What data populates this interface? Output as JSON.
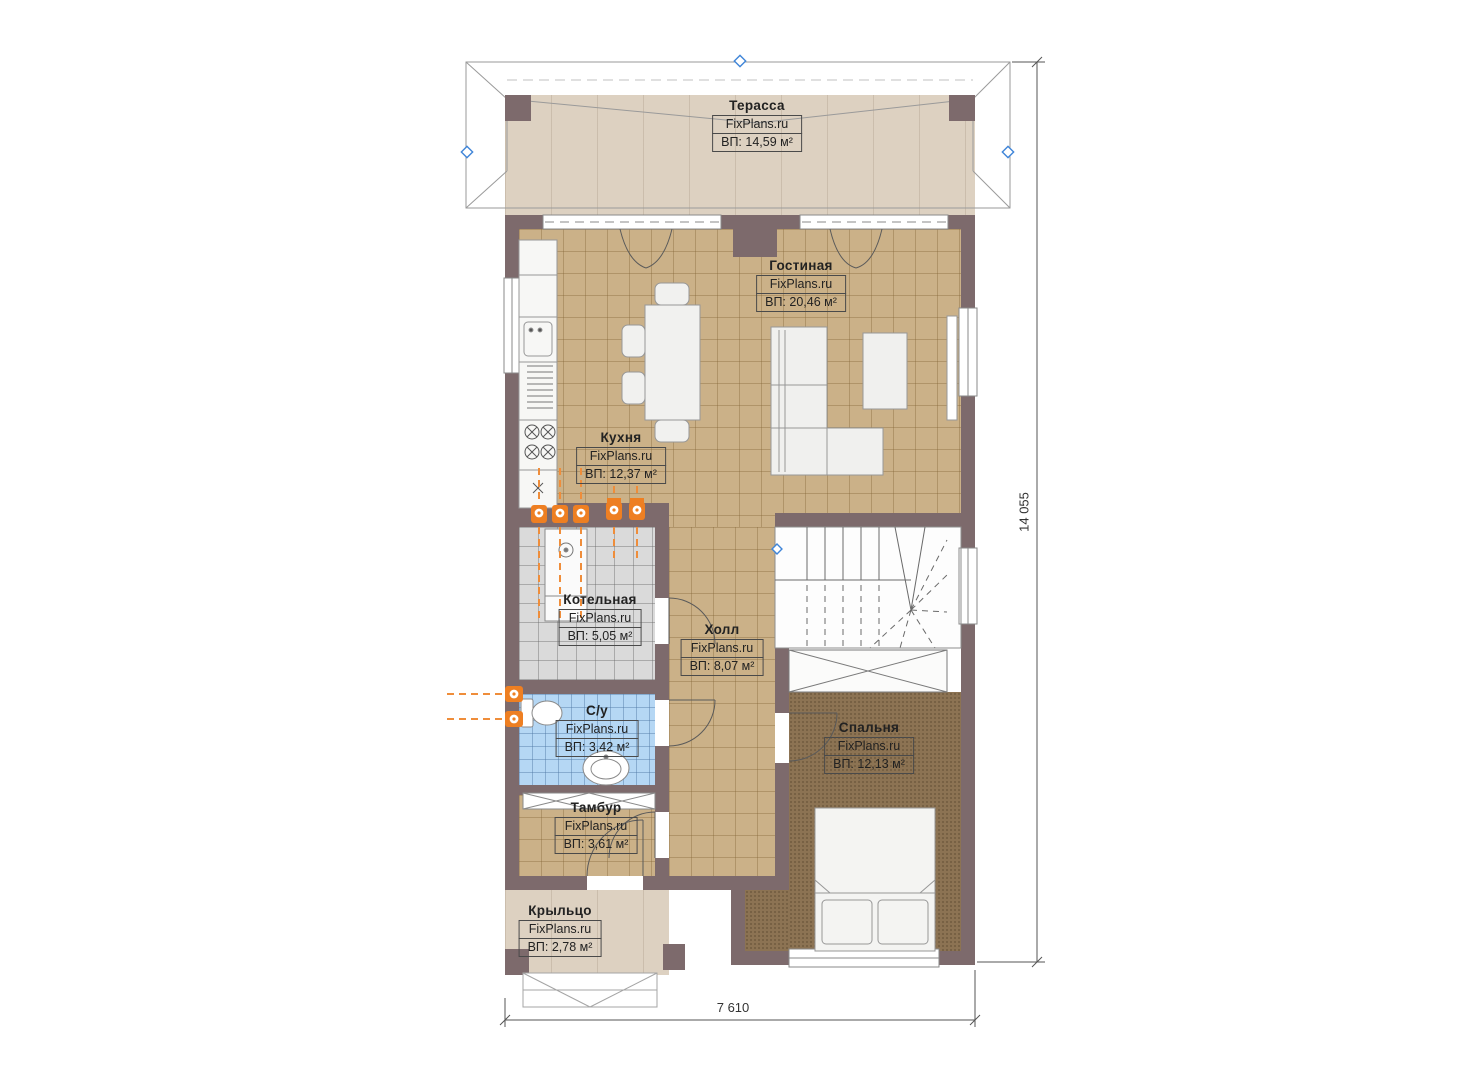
{
  "plan_title": "first-floor-plan",
  "rooms": [
    {
      "id": "terrace",
      "name": "Терасса",
      "watermark": "FixPlans.ru",
      "area": "ВП: 14,59 м²"
    },
    {
      "id": "living",
      "name": "Гостиная",
      "watermark": "FixPlans.ru",
      "area": "ВП: 20,46 м²"
    },
    {
      "id": "kitchen",
      "name": "Кухня",
      "watermark": "FixPlans.ru",
      "area": "ВП: 12,37 м²"
    },
    {
      "id": "boiler",
      "name": "Котельная",
      "watermark": "FixPlans.ru",
      "area": "ВП: 5,05 м²"
    },
    {
      "id": "hall",
      "name": "Холл",
      "watermark": "FixPlans.ru",
      "area": "ВП: 8,07 м²"
    },
    {
      "id": "bathroom",
      "name": "С/у",
      "watermark": "FixPlans.ru",
      "area": "ВП: 3,42 м²"
    },
    {
      "id": "bedroom",
      "name": "Спальня",
      "watermark": "FixPlans.ru",
      "area": "ВП: 12,13 м²"
    },
    {
      "id": "tambour",
      "name": "Тамбур",
      "watermark": "FixPlans.ru",
      "area": "ВП: 3,61 м²"
    },
    {
      "id": "porch",
      "name": "Крыльцо",
      "watermark": "FixPlans.ru",
      "area": "ВП: 2,78 м²"
    }
  ],
  "dimensions": {
    "height_total": "14 055",
    "width_total": "7 610"
  },
  "colors": {
    "wall": "#7d6a6c",
    "floor_tile": "#cbb188",
    "floor_boiler": "#dadada",
    "floor_bath": "#b5d7f4",
    "floor_bedroom": "#8c7353",
    "floor_terrace": "#ddd1c1",
    "utility_orange": "#ee7f22",
    "marker_blue": "#3f85d8"
  }
}
